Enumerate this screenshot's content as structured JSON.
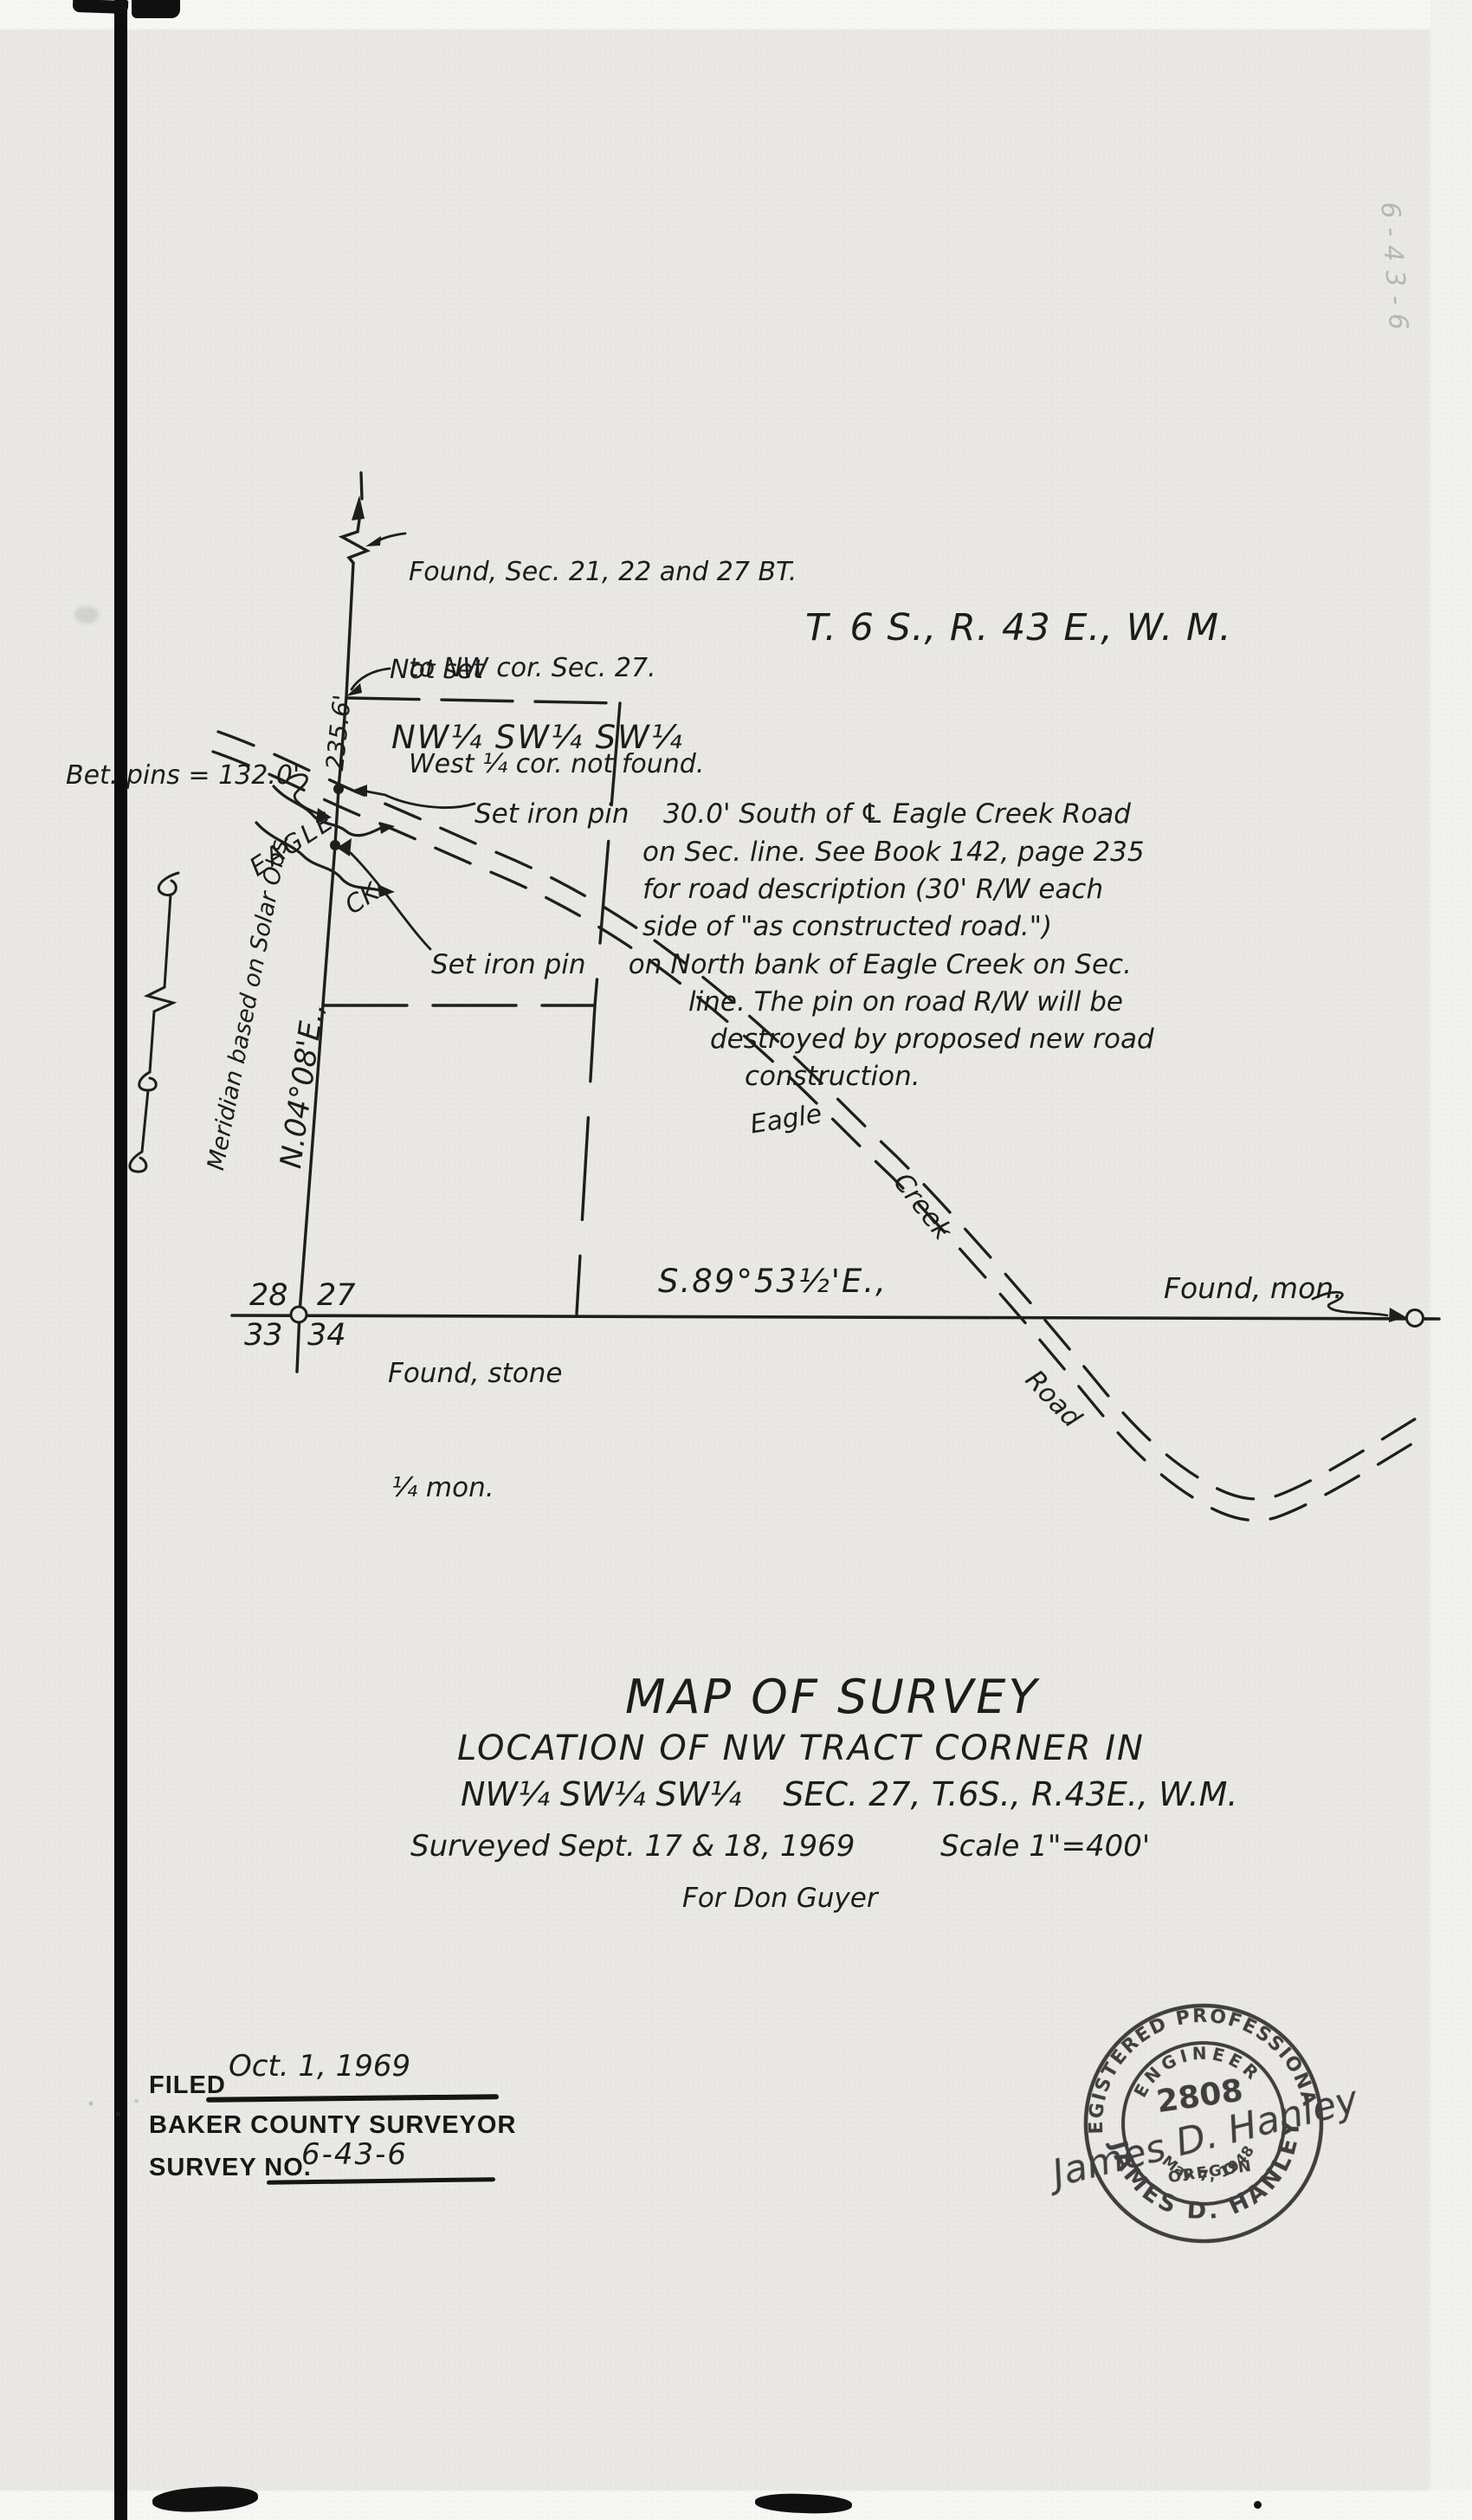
{
  "colors": {
    "ink": "#1e1e1e",
    "paper": "#e9e8e5"
  },
  "map": {
    "region_title": "T. 6 S., R. 43 E., W. M.",
    "corner_note": [
      "Found, Sec. 21, 22 and 27 BT.",
      "to NW cor. Sec. 27.",
      "West ¼ cor. not found."
    ],
    "not_set": "Not set",
    "tract_label": "NW¼ SW¼ SW¼",
    "dist_north": "235.6'",
    "between_pins": "Bet. pins = 132.0'",
    "creek_label_upper": "EAGLE",
    "creek_label_lower": "CK.",
    "meridian_note": "Meridian based on Solar Obs.",
    "bearing_section_line": "N.04°08'E.,",
    "road_note": [
      "Set iron pin    30.0' South of ℄ Eagle Creek Road",
      "on Sec. line. See Book 142, page 235",
      "for road description (30' R/W each",
      "side of \"as constructed road.\")"
    ],
    "creek_note": [
      "Set iron pin     on North bank of Eagle Creek on Sec.",
      "line. The pin on road R/W will be",
      "destroyed by proposed new road",
      "construction."
    ],
    "road_labels": {
      "word1": "Eagle",
      "word2": "Creek",
      "word3": "Road"
    },
    "corner_sections": {
      "nw": "28",
      "ne": "27",
      "sw": "33",
      "se": "34"
    },
    "found_stone": [
      "Found, stone",
      "¼ mon."
    ],
    "bearing_south_line": "S.89°53½'E.,",
    "found_mon": "Found, mon."
  },
  "title_block": {
    "title": "MAP OF SURVEY",
    "subtitle": "LOCATION OF NW TRACT CORNER IN",
    "legal": "NW¼ SW¼ SW¼    SEC. 27, T.6S., R.43E., W.M.",
    "surveyed": "Surveyed Sept. 17 & 18, 1969",
    "scale": "Scale 1\"=400'",
    "client": "For Don Guyer"
  },
  "filing": {
    "filed_label": "FILED",
    "filed_date": "Oct. 1, 1969",
    "office": "BAKER COUNTY SURVEYOR",
    "survey_no_label": "SURVEY NO.",
    "survey_no": "6-43-6"
  },
  "stamp": {
    "outer_top": "REGISTERED PROFESSIONAL",
    "outer_bottom": "JAMES D. HANLEY",
    "inner_top": "ENGINEER",
    "license": "2808",
    "signature": "James D. Hanley",
    "state": "OREGON",
    "date": "May 7, 1948"
  },
  "margin_note": "6-43-6"
}
